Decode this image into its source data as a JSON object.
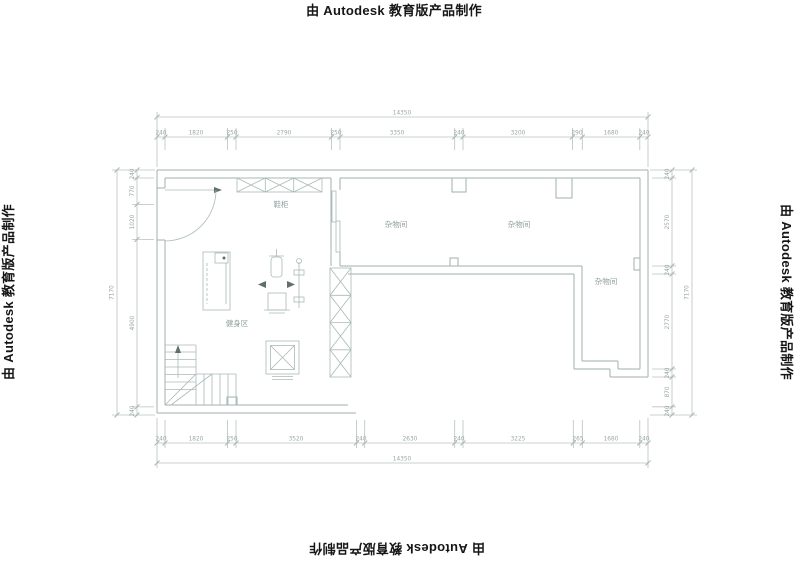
{
  "watermark": {
    "text": "由 Autodesk 教育版产品制作"
  },
  "rooms": {
    "shoe_cabinet": "鞋柜",
    "storage_left": "杂物间",
    "storage_mid": "杂物间",
    "storage_right": "杂物间",
    "fitness": "健身区"
  },
  "dimensions": {
    "top": {
      "total": "14350",
      "segments": [
        "240",
        "1820",
        "250",
        "2790",
        "250",
        "3350",
        "240",
        "3200",
        "290",
        "1680",
        "240"
      ]
    },
    "bottom": {
      "total": "14350",
      "segments": [
        "240",
        "1820",
        "250",
        "3520",
        "240",
        "2630",
        "240",
        "3225",
        "265",
        "1680",
        "240"
      ]
    },
    "left": {
      "total": "7170",
      "segments": [
        "240",
        "770",
        "1020",
        "4900",
        "240"
      ]
    },
    "right": {
      "total": "7170",
      "segments": [
        "240",
        "2570",
        "240",
        "2770",
        "240",
        "870",
        "240"
      ]
    }
  }
}
